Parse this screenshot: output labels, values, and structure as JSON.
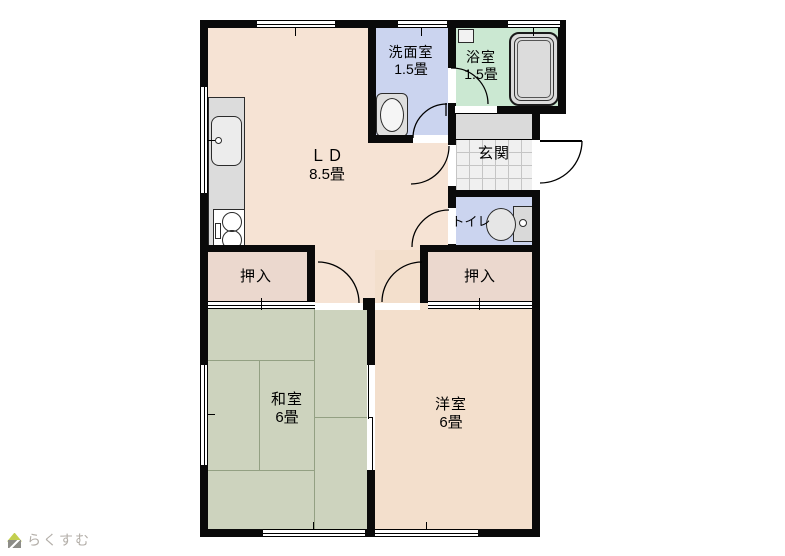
{
  "watermark": {
    "brand": "らくすむ"
  },
  "rooms": {
    "ld": {
      "name": "ＬＤ",
      "size": "8.5畳"
    },
    "senmenshitsu": {
      "name": "洗面室",
      "size": "1.5畳"
    },
    "yokushitsu": {
      "name": "浴室",
      "size": "1.5畳"
    },
    "genkan": {
      "name": "玄関"
    },
    "toilet": {
      "name": "トイレ"
    },
    "oshiire_left": {
      "name": "押入"
    },
    "oshiire_right": {
      "name": "押入"
    },
    "washitsu": {
      "name": "和室",
      "size": "6畳"
    },
    "youshitsu": {
      "name": "洋室",
      "size": "6畳"
    }
  },
  "colors": {
    "wall": "#0A0A0A",
    "ld_floor": "#F6E3D4",
    "western_room_floor": "#F3DFCC",
    "tatami_floor": "#CDD3BE",
    "closet_floor": "#EBD8CE",
    "wet_room_floor": "#CBD4EF",
    "bath_floor": "#CBE8D2",
    "hall_floor": "#DADADA",
    "tile_floor": "#F0F0F0"
  }
}
